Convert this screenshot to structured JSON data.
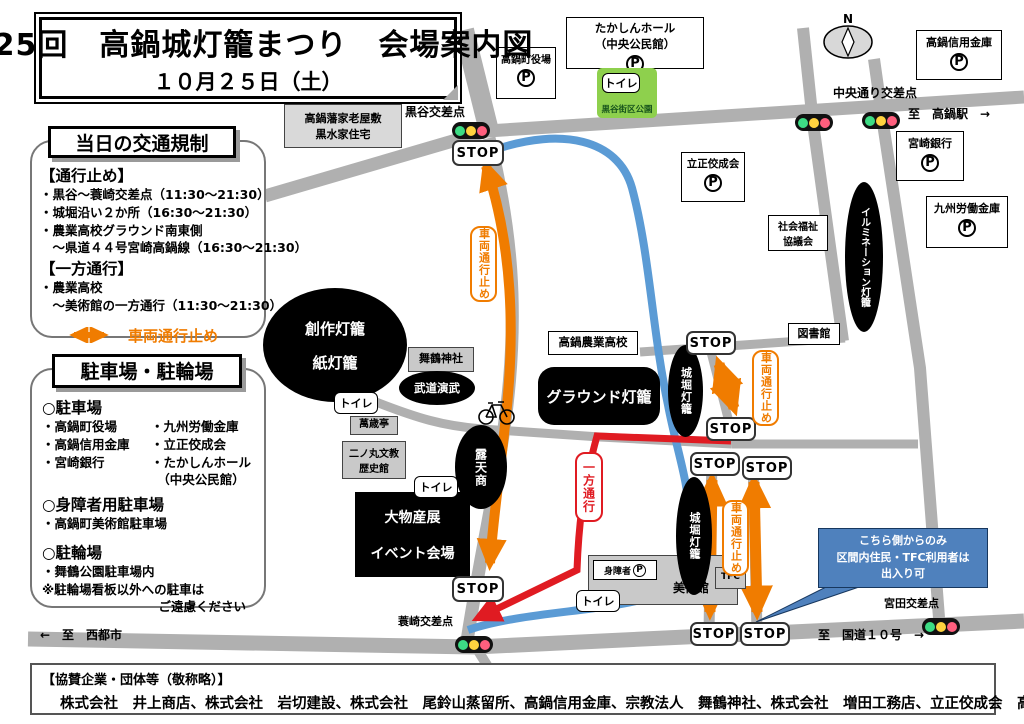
{
  "title": {
    "line1": "第25回　高鍋城灯籠まつり　会場案内図",
    "line2": "１０月２５日（土）"
  },
  "traffic_box": {
    "header": "当日の交通規制",
    "closed_header": "【通行止め】",
    "closed_items": [
      "・黒谷～蓑崎交差点（11:30～21:30）",
      "・城堀沿い２か所（16:30～21:30）",
      "・農業高校グラウンド南東側",
      "　～県道４４号宮崎高鍋線（16:30～21:30）"
    ],
    "oneway_header": "【一方通行】",
    "oneway_items": [
      "・農業高校",
      "　～美術館の一方通行（11:30～21:30）"
    ],
    "legend_vehicle_closed": "車両通行止め",
    "legend_oneway": "一方通行"
  },
  "parking_box": {
    "header": "駐車場・駐輪場",
    "car_header": "○駐車場",
    "car_left": [
      "・高鍋町役場",
      "・高鍋信用金庫",
      "・宮崎銀行"
    ],
    "car_right": [
      "・九州労働金庫",
      "・立正佼成会",
      "・たかしんホール",
      "　（中央公民館）"
    ],
    "disabled_header": "○身障者用駐車場",
    "disabled_item": "・高鍋町美術館駐車場",
    "bicycle_header": "○駐輪場",
    "bicycle_item": "・舞鶴公園駐車場内",
    "note1": "※駐輪場看板以外への駐車は",
    "note2": "ご遠慮ください"
  },
  "map": {
    "stop": "STOP",
    "toilet": "トイレ",
    "vehicle_closed": "車両通行止め",
    "oneway": "一方通行",
    "north": "N",
    "labels": {
      "kurotani": "黒谷交差点",
      "chuo_dori": "中央通り交差点",
      "to_takanabe_sta": "至　高鍋駅　→",
      "minosaki": "蓑崎交差点",
      "miyata": "宮田交差点",
      "to_saito": "←　至　西都市",
      "to_route10": "至　国道１０号　→"
    },
    "facilities": {
      "kuroki_house1": "高鍋藩家老屋敷",
      "kuroki_house2": "黒水家住宅",
      "yakuba": "高鍋町役場",
      "takashin1": "たかしんホール",
      "takashin2": "（中央公民館）",
      "park": "黒谷街区公園",
      "shinkin": "高鍋信用金庫",
      "miyazaki_bank": "宮崎銀行",
      "rokin": "九州労働金庫",
      "rissho": "立正佼成会",
      "shakyo1": "社会福祉",
      "shakyo2": "協議会",
      "library": "図書館",
      "nogyo_hs": "高鍋農業高校",
      "maizuru": "舞鶴神社",
      "manzaitei": "萬歳亭",
      "ninomaru1": "二ノ丸文教",
      "ninomaru2": "歴史館",
      "museum": "美術館",
      "disabled": "身障者",
      "tfc": "TFC",
      "p": "P"
    },
    "venues": {
      "sosaku1": "創作灯籠",
      "sosaku2": "紙灯籠",
      "budo": "武道演武",
      "roten": "露天商",
      "ground": "グラウンド灯籠",
      "jobori": "城堀灯籠",
      "illumination": "イルミネーション灯籠",
      "bussan1": "大物産展",
      "bussan2": "イベント会場"
    },
    "callout": {
      "line1": "こちら側からのみ",
      "line2": "区間内住民・TFC利用者は",
      "line3": "出入り可"
    }
  },
  "sponsors": {
    "header": "【協賛企業・団体等（敬称略）】",
    "companies": "株式会社　井上商店、株式会社　岩切建設、株式会社　尾鈴山蒸留所、高鍋信用金庫、宗教法人　舞鶴神社、株式会社　増田工務店、立正佼成会　高鍋教会"
  }
}
